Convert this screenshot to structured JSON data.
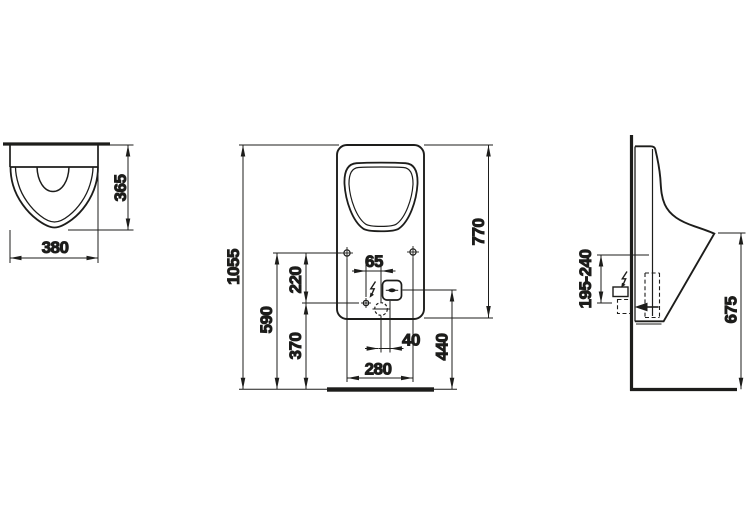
{
  "drawing": {
    "type": "sanitary-ware technical dimension drawing (urinal, three orthographic views)",
    "background_color": "#ffffff",
    "line_color": "#1d1d1b",
    "views": {
      "top": {
        "dims": {
          "width": "380",
          "depth": "365"
        }
      },
      "front": {
        "dims": {
          "overall_height": "1055",
          "bowl_height": "770",
          "mount_height": "590",
          "inlet_height": "370",
          "mount_to_inlet": "220",
          "inlet_to_axis": "65",
          "axis_to_sensor": "40",
          "sensor_height": "440",
          "mount_spacing": "280"
        }
      },
      "side": {
        "dims": {
          "connection_height_range": "195-240",
          "rim_height": "675"
        }
      }
    },
    "icons": {
      "electrical_connection": "lightning-bolt-icon",
      "mounting_hole": "crosshair-circle-icon",
      "water_inlet": "crosshair-circle-icon",
      "drain_outlet": "dashed-crosshair-circle-icon",
      "sensor_window": "lens-icon",
      "flow_direction": "left-arrow-icon"
    }
  }
}
